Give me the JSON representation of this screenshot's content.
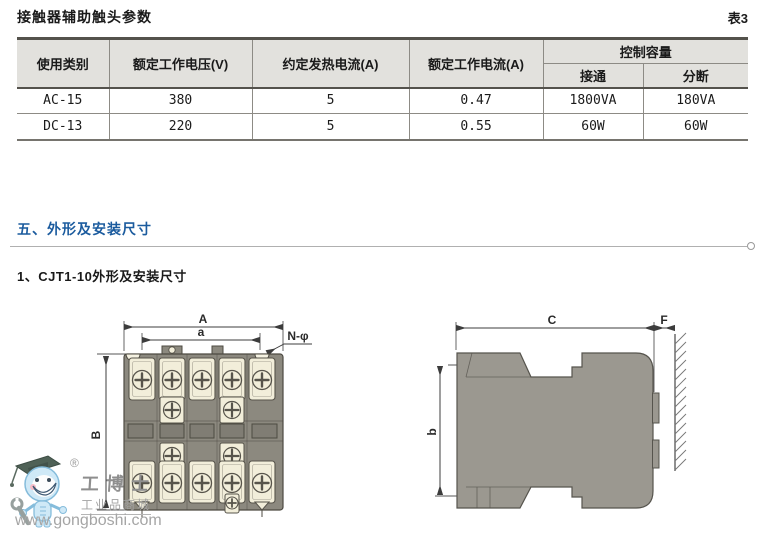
{
  "page": {
    "doc_title": "接触器辅助触头参数",
    "table_no": "表3",
    "section_title": "五、外形及安装尺寸",
    "subsection_title": "1、CJT1-10外形及安装尺寸"
  },
  "table": {
    "columns": [
      "使用类别",
      "额定工作电压(V)",
      "约定发热电流(A)",
      "额定工作电流(A)"
    ],
    "control_capacity_header": "控制容量",
    "sub_columns": [
      "接通",
      "分断"
    ],
    "rows": [
      [
        "AC-15",
        "380",
        "5",
        "0.47",
        "1800VA",
        "180VA"
      ],
      [
        "DC-13",
        "220",
        "5",
        "0.55",
        "60W",
        "60W"
      ]
    ]
  },
  "drawings": {
    "front_view": {
      "width_label": "A",
      "hole_span_label": "a",
      "holes_label": "N-φ",
      "height_label": "B"
    },
    "side_view": {
      "depth_label": "C",
      "gap_label": "F",
      "height_label": "b"
    }
  },
  "watermark": {
    "registered_mark": "®",
    "brand": "工博士",
    "tagline": "工业品商城",
    "url": "www.gongboshi.com"
  },
  "colors": {
    "accent_blue": "#1b5b9e",
    "table_header_bg": "#e2e1dd",
    "front_body_gray": "#8c897f",
    "side_body_gray": "#9b9890",
    "terminal_cream": "#f2eeda",
    "watermark_gray": "#a5a5a5"
  }
}
